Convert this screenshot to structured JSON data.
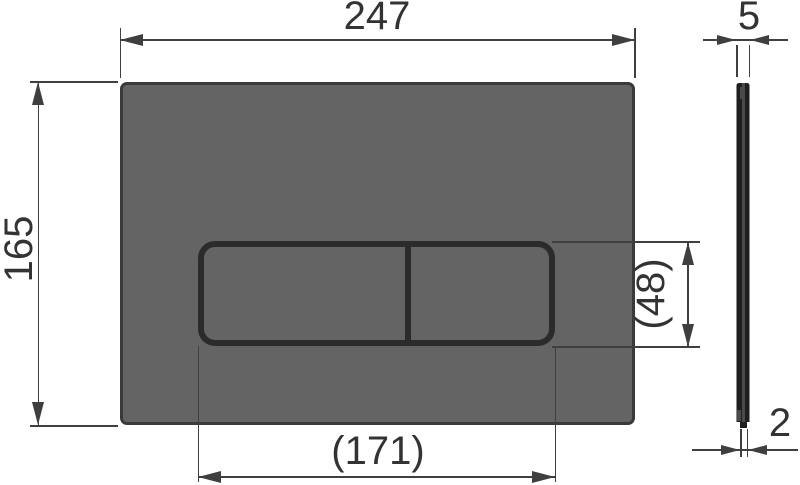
{
  "dims": {
    "width": "247",
    "height": "165",
    "panel_width": "(171)",
    "panel_height": "(48)",
    "thickness": "5",
    "edge_thickness": "2"
  },
  "colors": {
    "background": "#ffffff",
    "plate_fill": "#646464",
    "plate_border": "#3a3a3a",
    "button_outline": "#2b2b2b",
    "dimension_line": "#3f3f3f",
    "label_text": "#333333",
    "side_profile_dark": "#1f1f1f",
    "side_profile_mid": "#4a4a4a",
    "side_profile_edge": "#8a8a8a"
  }
}
